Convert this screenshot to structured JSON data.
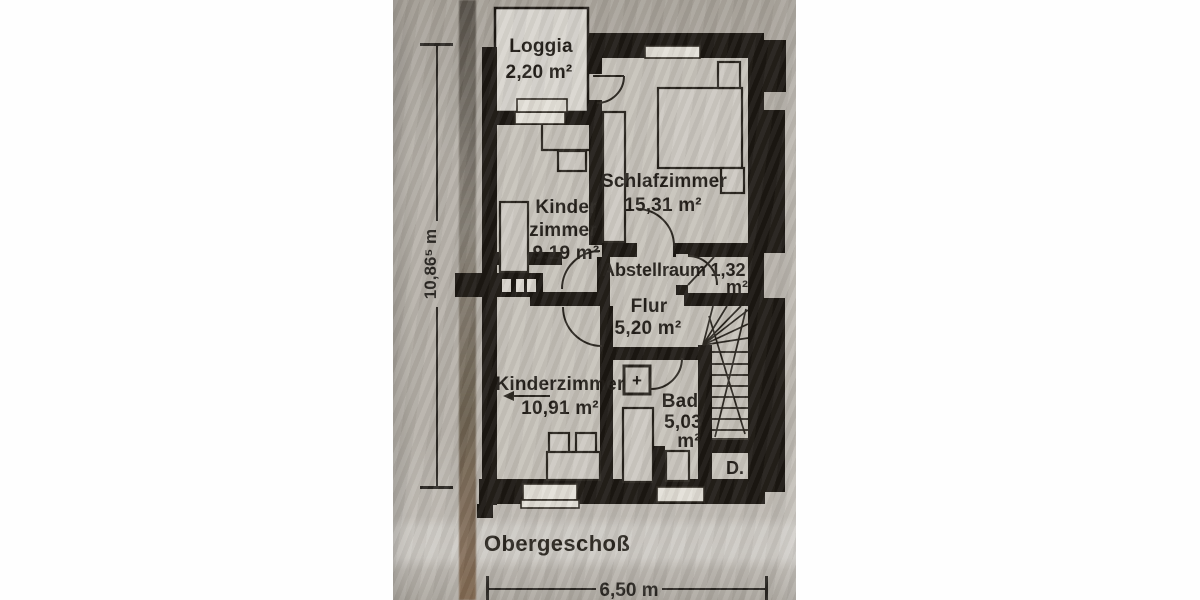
{
  "floor_plan": {
    "title": "Obergeschoß",
    "dimension_height": "10,86⁵ m",
    "dimension_width": "6,50 m",
    "rooms": {
      "loggia": {
        "name": "Loggia",
        "area": "2,20 m²"
      },
      "schlafzimmer": {
        "name": "Schlafzimmer",
        "area": "15,31 m²"
      },
      "kinderzimmer_oben": {
        "name_line1": "Kinder",
        "name_line2": "zimmer",
        "area": "9,19 m²"
      },
      "abstellraum": {
        "name": "Abstellraum",
        "area_value": "1,32",
        "area_unit": "m²"
      },
      "flur": {
        "name": "Flur",
        "area": "5,20 m²"
      },
      "kinderzimmer_unten": {
        "name": "Kinderzimmer",
        "area": "10,91 m²"
      },
      "bad": {
        "name": "Bad",
        "area_value": "5,03",
        "area_unit": "m²"
      },
      "abgang": {
        "label": "D."
      }
    },
    "symbols": {
      "washbasin_cross": "+"
    },
    "colors": {
      "ink": "#1b1712",
      "paper": "#b6b1a9",
      "room_fill": "#c6c2ba",
      "loggia_fill": "#d8d5ce",
      "streak_brown": "#6f5741",
      "page": "#fefefe"
    }
  }
}
